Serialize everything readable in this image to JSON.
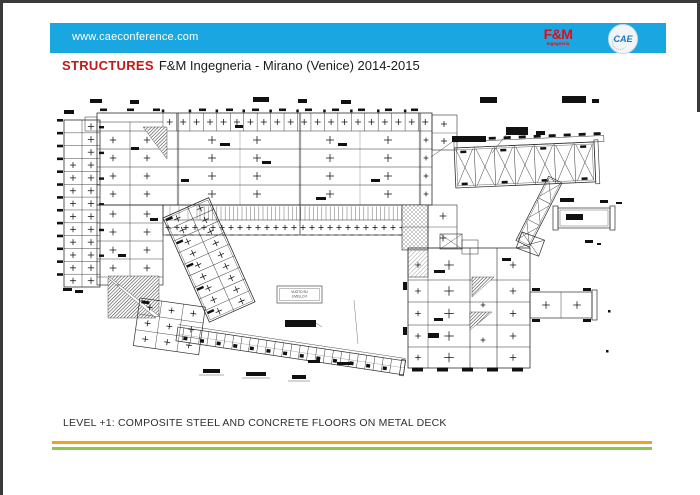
{
  "slide": {
    "background": "#ffffff",
    "frame_color": "#3a3a3a"
  },
  "header": {
    "bar_color": "#1AA7E1",
    "url": "www.caeconference.com",
    "fm_logo": {
      "name": "F&M",
      "sub": "Ingegneria",
      "color": "#E30B17"
    },
    "cae_logo": {
      "name": "CAE",
      "color": "#1C75BC"
    }
  },
  "title": {
    "keyword": "STRUCTURES",
    "keyword_color": "#C2181B",
    "text": "F&M Ingegneria - Mirano (Venice) 2014-2015"
  },
  "plan": {
    "void_label_line1": "VUOTO SU",
    "void_label_line2": "LIVELLO 0",
    "line_color": "#2e2e2e"
  },
  "caption": "LEVEL +1: COMPOSITE STEEL AND CONCRETE FLOORS ON METAL DECK",
  "footer": {
    "stripe_orange": "#F5A120",
    "stripe_green": "#8EC64C"
  }
}
